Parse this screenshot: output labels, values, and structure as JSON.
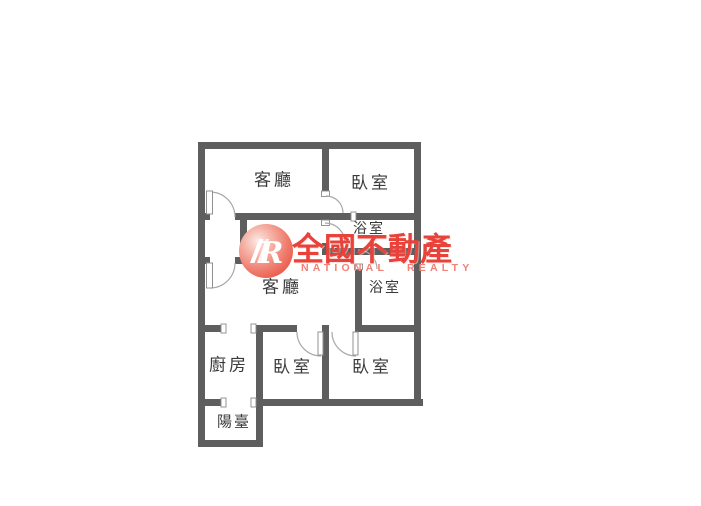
{
  "floor_plan": {
    "rooms": [
      {
        "id": "living-room-upper",
        "label": "客廳"
      },
      {
        "id": "bedroom-upper-right",
        "label": "臥室"
      },
      {
        "id": "bathroom-upper",
        "label": "浴室"
      },
      {
        "id": "bathroom-lower",
        "label": "浴室"
      },
      {
        "id": "living-room-lower",
        "label": "客廳"
      },
      {
        "id": "kitchen",
        "label": "廚房"
      },
      {
        "id": "bedroom-lower-middle",
        "label": "臥室"
      },
      {
        "id": "bedroom-lower-right",
        "label": "臥室"
      },
      {
        "id": "balcony",
        "label": "陽臺"
      }
    ],
    "wall_color": "#5e5e5e",
    "door_arc_color": "#a8a8a8",
    "background_color": "#ffffff",
    "label_color": "#3a3a3a"
  },
  "watermark": {
    "logo_letter": "R",
    "brand_zh": "全國不動產",
    "brand_en": "NATIONAL REALTY",
    "brand_color": "#e8423a",
    "brand_color_light": "#ef8177",
    "logo_circle_colors": [
      "#fcebe6",
      "#f6b4a9",
      "#ef7b6c",
      "#e94a3b"
    ]
  }
}
